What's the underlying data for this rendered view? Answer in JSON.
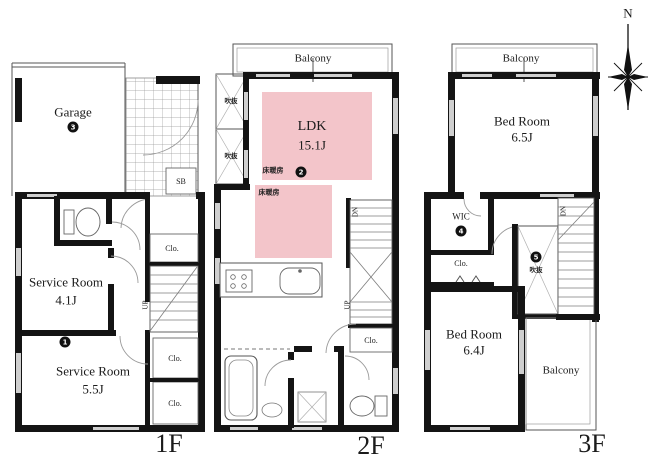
{
  "colors": {
    "wall": "#141414",
    "heated_floor": "#f3c5ca",
    "paper": "#ffffff"
  },
  "compass": {
    "north_label": "N"
  },
  "floor_1": {
    "floor_label": "1F",
    "garage_label": "Garage",
    "garage_badge": "3",
    "shoe_box_label": "SB",
    "service_room_a_name": "Service Room",
    "service_room_a_size": "4.1J",
    "service_room_b_name": "Service Room",
    "service_room_b_size": "5.5J",
    "service_room_b_badge": "1",
    "closet_label_a": "Clo.",
    "closet_label_b": "Clo.",
    "closet_label_c": "Clo.",
    "stairs_up_label": "UP"
  },
  "floor_2": {
    "floor_label": "2F",
    "balcony_label": "Balcony",
    "void_label_a": "吹抜",
    "void_label_b": "吹抜",
    "ldk_name": "LDK",
    "ldk_size": "15.1J",
    "ldk_badge": "2",
    "floor_heating_label_a": "床暖房",
    "floor_heating_label_b": "床暖房",
    "closet_label": "Clo.",
    "stairs_down_label": "DN",
    "stairs_up_label": "UP"
  },
  "floor_3": {
    "floor_label": "3F",
    "balcony_top_label": "Balcony",
    "balcony_side_label": "Balcony",
    "bedroom_a_name": "Bed Room",
    "bedroom_a_size": "6.5J",
    "wic_label": "WIC",
    "wic_badge": "4",
    "closet_label": "Clo.",
    "void_label": "吹抜",
    "void_badge": "5",
    "stairs_down_label": "DN",
    "bedroom_b_name": "Bed Room",
    "bedroom_b_size": "6.4J"
  }
}
